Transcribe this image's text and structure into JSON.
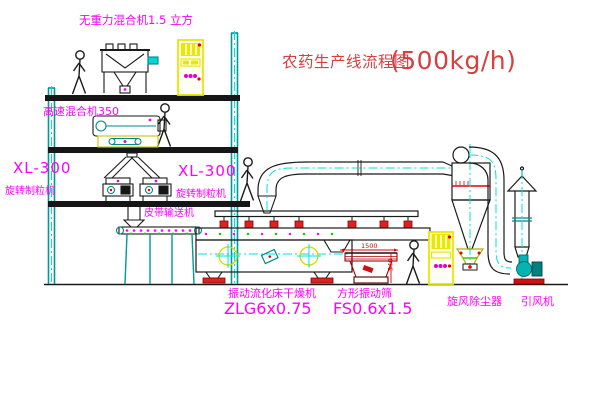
{
  "title": {
    "name_cn": "农药生产线流程图",
    "capacity": "(500kg/h)"
  },
  "equipment_labels": {
    "gravity_mixer": "无重力混合机1.5 立方",
    "high_speed_mixer": "高速混合机350",
    "granulator_left": {
      "model": "XL-300",
      "name": "旋转制粒机"
    },
    "granulator_right": {
      "model": "XL-300",
      "name": "旋转制粒机"
    },
    "belt_conveyor": "皮带输送机",
    "fluid_bed_dryer": {
      "name": "振动流化床干燥机",
      "model": "ZLG6x0.75"
    },
    "vibrating_screen": {
      "name": "方形振动筛",
      "model": "FS0.6x1.5"
    },
    "cyclone": "旋风除尘器",
    "induced_draft_fan": "引风机"
  },
  "dimensions": {
    "screen_length": "1500",
    "screen_height": "540"
  },
  "colors": {
    "line_teal": "#009898",
    "centerline_cyan": "#00e0e0",
    "label_magenta": "#ff00ff",
    "title_red": "#d54040",
    "cabinet_yellow": "#e8e800",
    "accent_red": "#ee0000",
    "drawing_black": "#1a1a1a"
  }
}
